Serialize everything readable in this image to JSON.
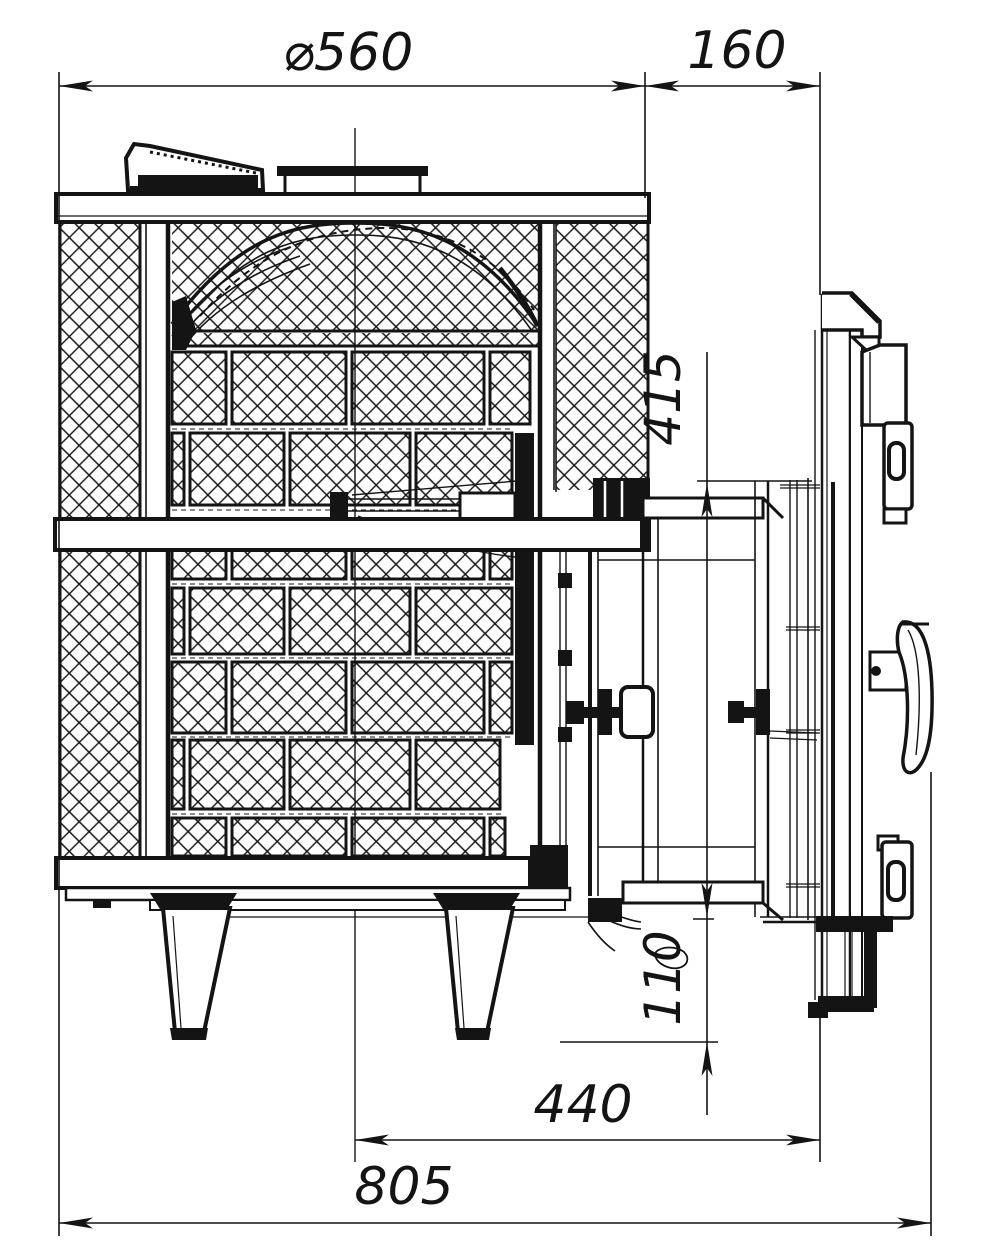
{
  "drawing": {
    "kind": "technical-drawing",
    "subject": "wood-burning sauna stove, side section view",
    "background_color": "#ffffff",
    "line_color": "#141414",
    "dimensions": {
      "top_diameter": "⌀560",
      "door_tunnel_offset": "160",
      "door_opening_height": "415",
      "bottom_clearance": "110",
      "axis_to_door_face": "440",
      "overall_depth": "805"
    }
  }
}
